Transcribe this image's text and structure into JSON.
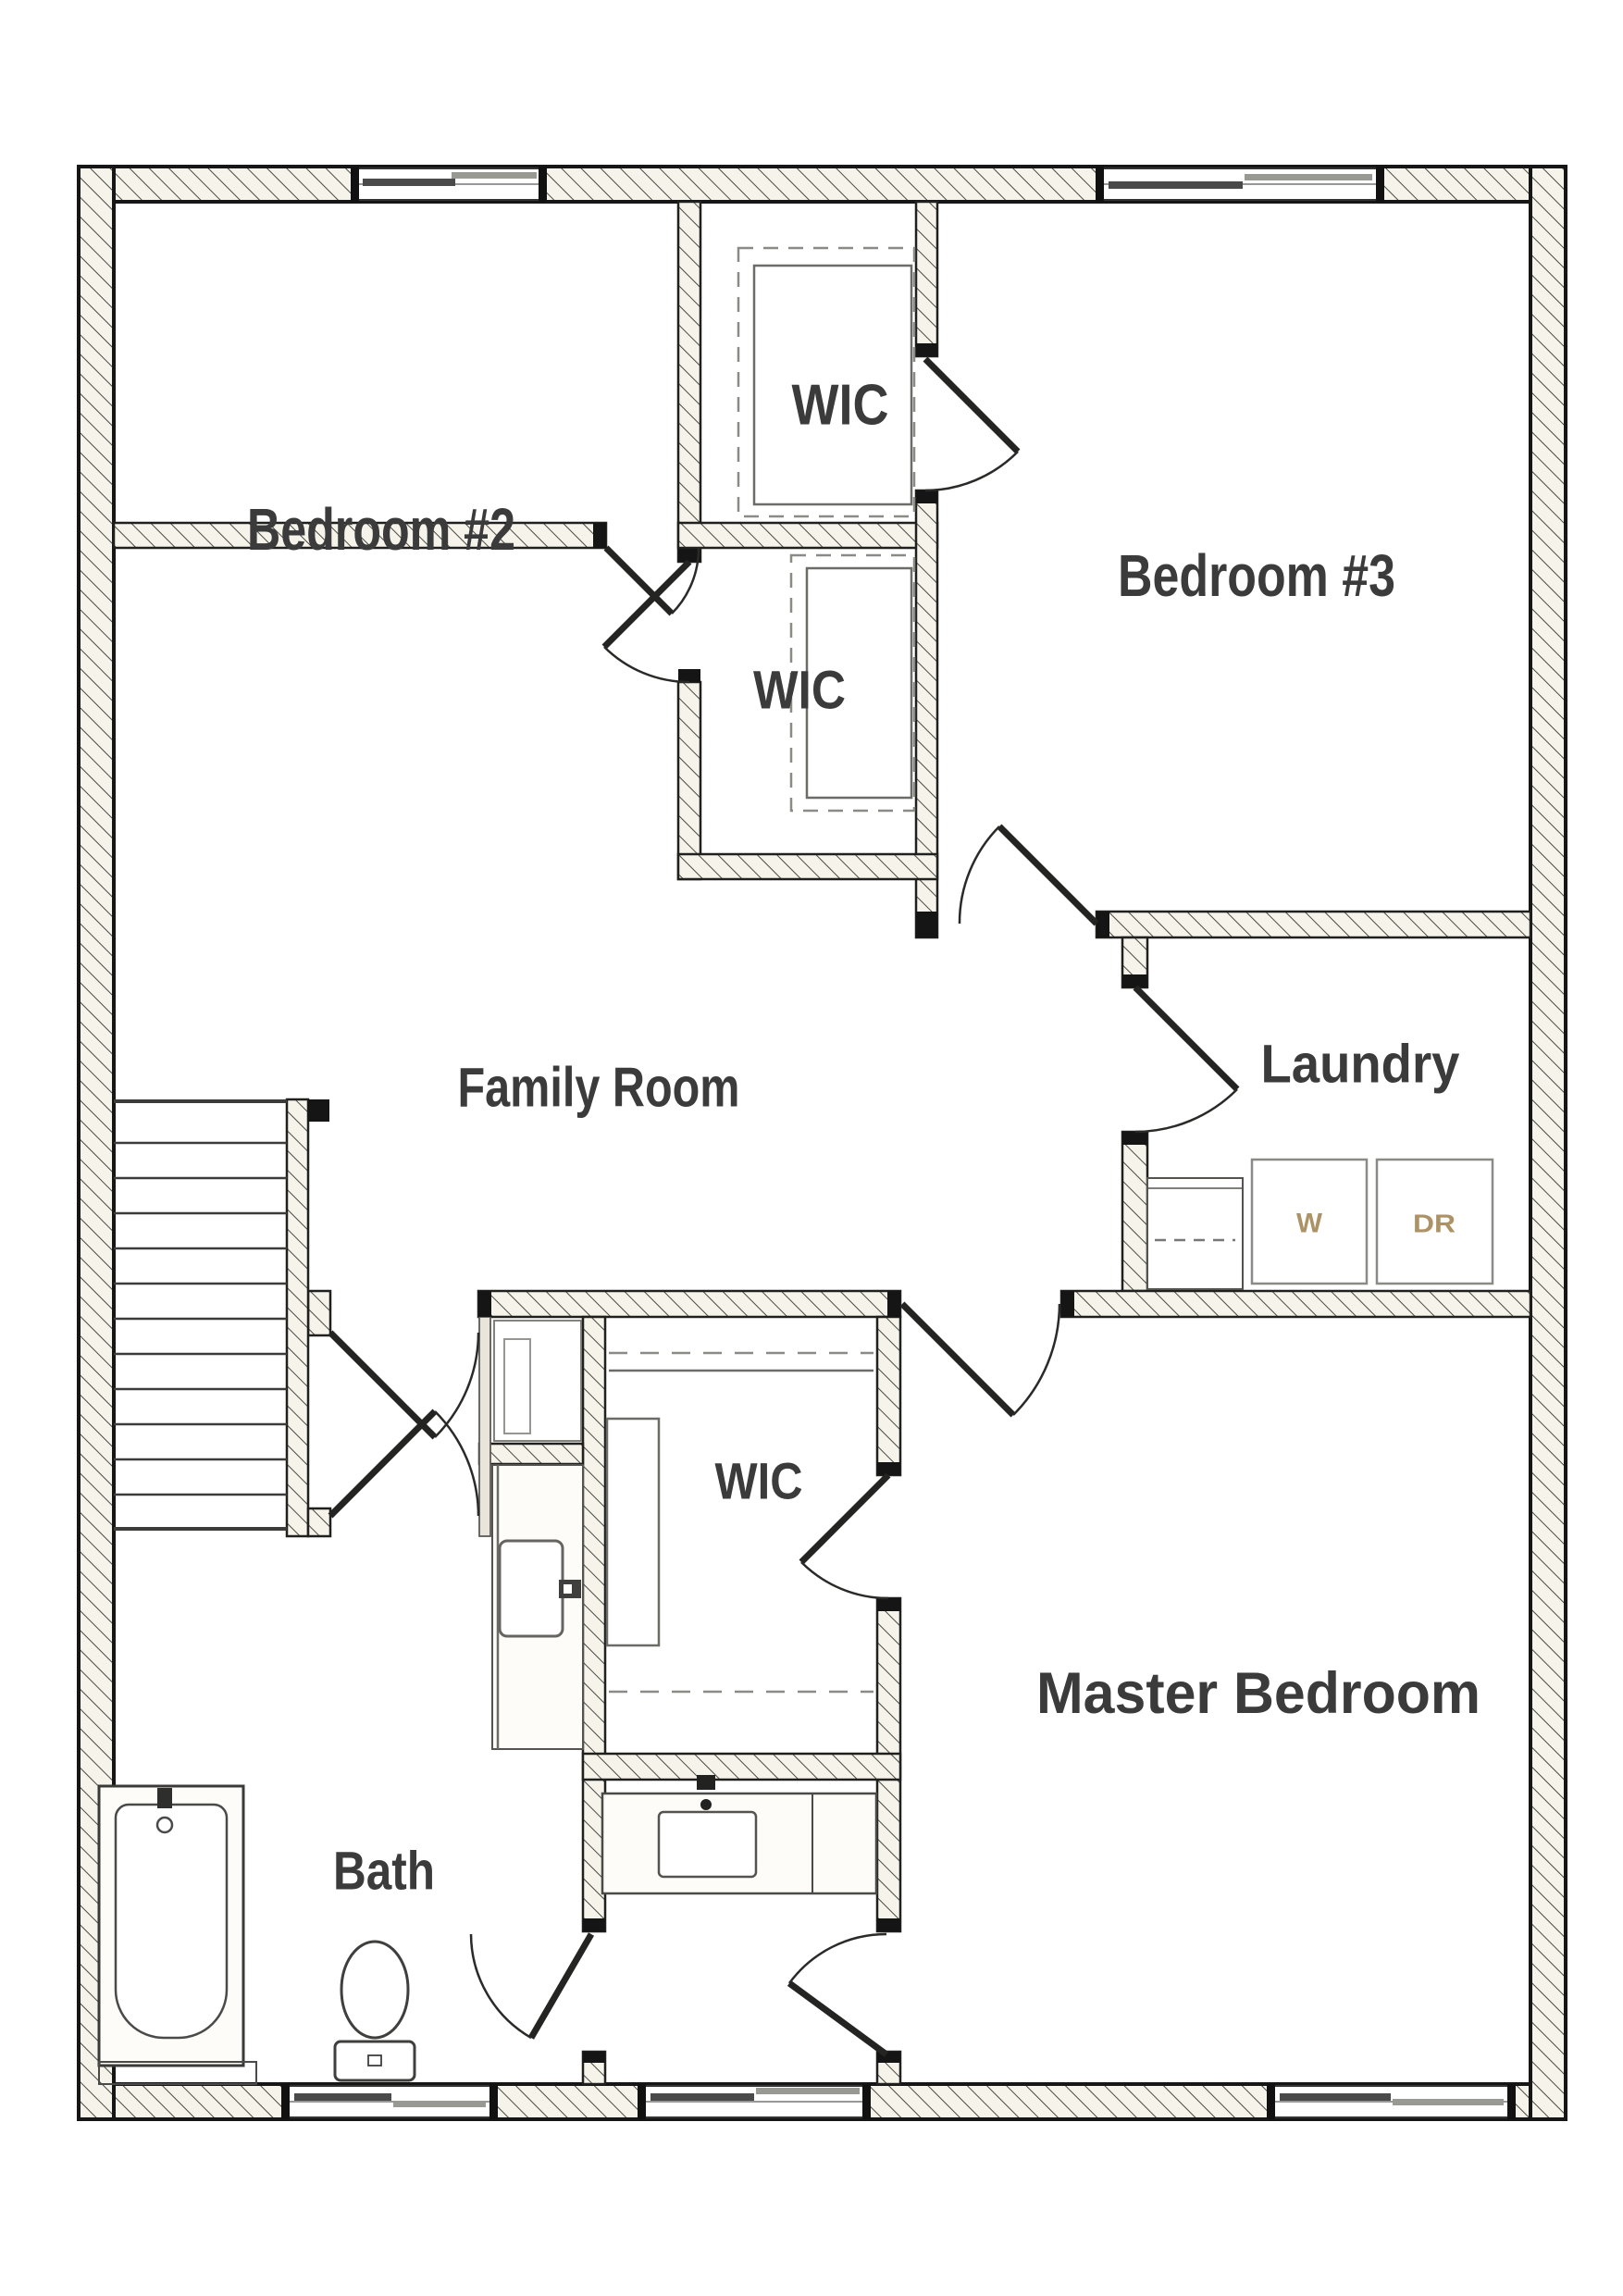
{
  "floor_plan": {
    "rooms": [
      {
        "id": "bedroom2",
        "label": "Bedroom #2"
      },
      {
        "id": "wic_top",
        "label": "WIC"
      },
      {
        "id": "bedroom3",
        "label": "Bedroom #3"
      },
      {
        "id": "wic_mid",
        "label": "WIC"
      },
      {
        "id": "family_room",
        "label": "Family Room"
      },
      {
        "id": "laundry",
        "label": "Laundry"
      },
      {
        "id": "wic_master",
        "label": "WIC"
      },
      {
        "id": "master_bedroom",
        "label": "Master Bedroom"
      },
      {
        "id": "bath",
        "label": "Bath"
      }
    ],
    "appliances": [
      {
        "id": "washer",
        "label": "W"
      },
      {
        "id": "dryer",
        "label": "DR"
      }
    ],
    "colors": {
      "wall_fill": "#f6f3ea",
      "wall_hatch_line": "#4a4a46",
      "wall_edge": "#1c1c1c",
      "fixture_line": "#4a4a48",
      "label": "#3b3b3b",
      "appliance_label": "#ac9265"
    }
  }
}
